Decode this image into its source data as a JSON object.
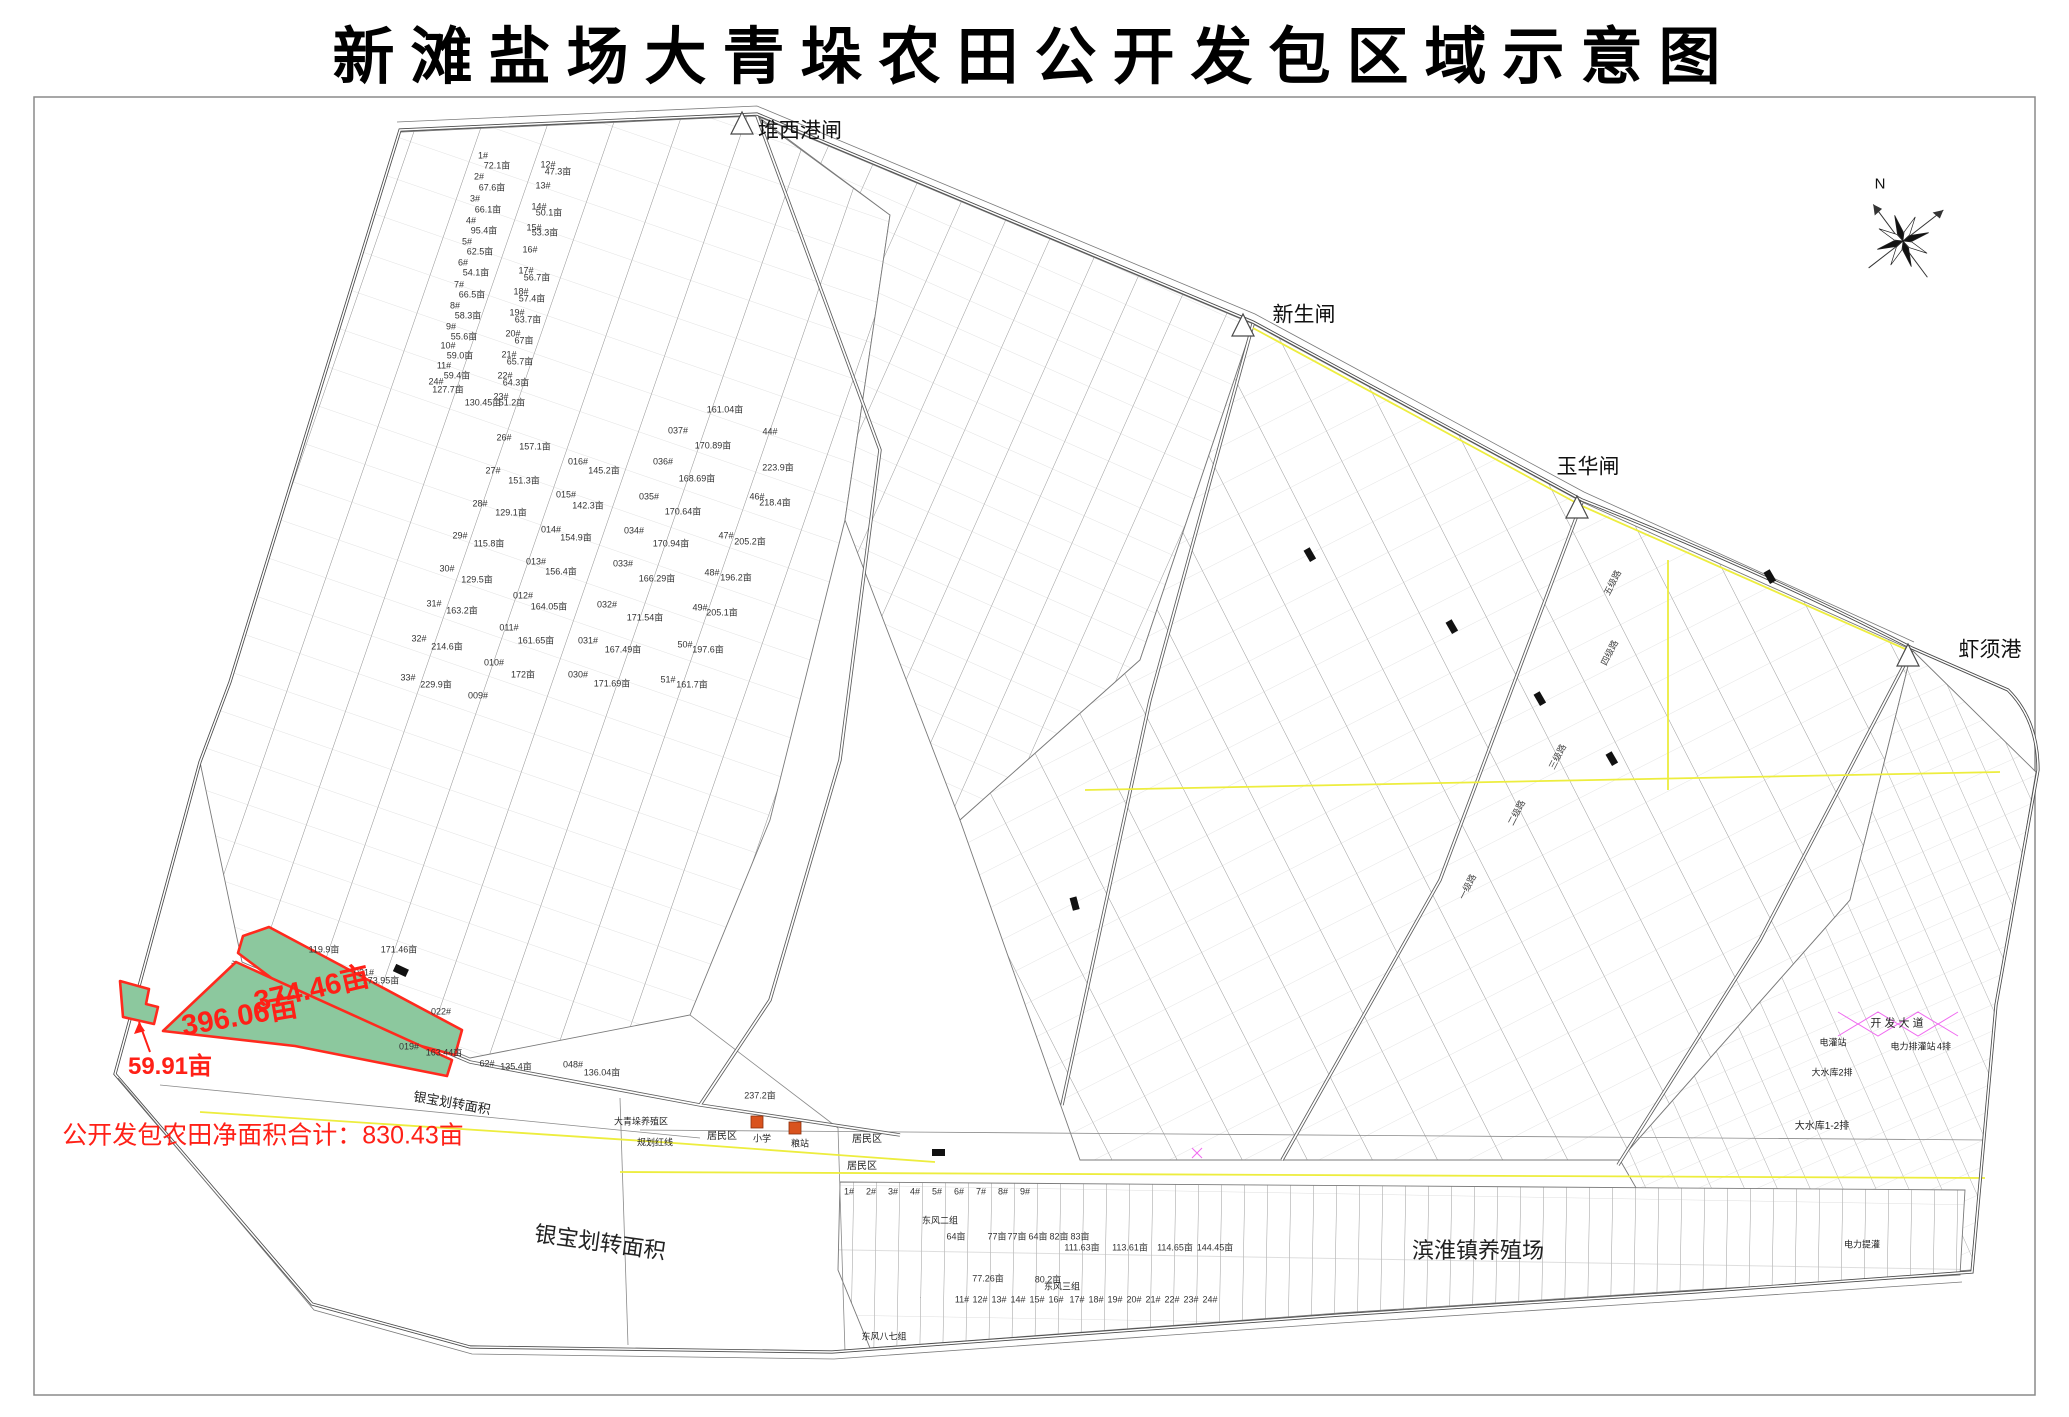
{
  "title": "新滩盐场大青垛农田公开发包区域示意图",
  "map": {
    "colors": {
      "highlight_fill": "#8CC89E",
      "highlight_stroke": "#FF2A1E",
      "highlight_text": "#FF2017",
      "road_yellow": "#EDED3E",
      "accent_magenta": "#F06AF0",
      "school_orange": "#D9531E",
      "line_gray": "#555555"
    },
    "gates": [
      {
        "t": "堆西港闸",
        "x": 800,
        "y": 131
      },
      {
        "t": "新生闸",
        "x": 1304,
        "y": 315
      },
      {
        "t": "玉华闸",
        "x": 1588,
        "y": 467
      },
      {
        "t": "虾须港",
        "x": 1990,
        "y": 650
      }
    ],
    "compass": [
      {
        "t": "N",
        "x": 1880,
        "y": 184
      }
    ],
    "highlights": [
      {
        "t": "374.46亩",
        "x": 312,
        "y": 990,
        "r": -13
      },
      {
        "t": "396.06亩",
        "x": 240,
        "y": 1017,
        "r": -10
      },
      {
        "t": "59.91亩",
        "x": 170,
        "y": 1067,
        "s": 24
      }
    ],
    "notes": [
      {
        "t": "公开发包农田净面积合计：830.43亩",
        "x": 263,
        "y": 1136
      }
    ],
    "zones": [
      {
        "t": "银宝划转面积",
        "x": 600,
        "y": 1243,
        "r": 8
      },
      {
        "t": "银宝划转面积",
        "x": 452,
        "y": 1103,
        "s": 13,
        "r": 10
      },
      {
        "t": "滨淮镇养殖场",
        "x": 1478,
        "y": 1251
      },
      {
        "t": "居民区",
        "x": 722,
        "y": 1137,
        "s": 10
      },
      {
        "t": "居民区",
        "x": 867,
        "y": 1140,
        "s": 10
      },
      {
        "t": "居民区",
        "x": 862,
        "y": 1167,
        "s": 10
      },
      {
        "t": "大青垛养殖区",
        "x": 641,
        "y": 1122,
        "s": 9
      },
      {
        "t": "规划红线",
        "x": 655,
        "y": 1143,
        "s": 9
      },
      {
        "t": "东风二组",
        "x": 940,
        "y": 1221,
        "s": 9
      },
      {
        "t": "东风三组",
        "x": 1062,
        "y": 1287,
        "s": 9
      },
      {
        "t": "东风八七组",
        "x": 884,
        "y": 1337,
        "s": 9
      },
      {
        "t": "大水库1-2排",
        "x": 1822,
        "y": 1127,
        "s": 10
      },
      {
        "t": "大水库2排",
        "x": 1832,
        "y": 1073,
        "s": 9
      },
      {
        "t": "电力排灌站",
        "x": 1913,
        "y": 1047,
        "s": 9
      },
      {
        "t": "电灌站",
        "x": 1833,
        "y": 1043,
        "s": 9
      },
      {
        "t": "电力提灌",
        "x": 1862,
        "y": 1245,
        "s": 9
      },
      {
        "t": "4排",
        "x": 1944,
        "y": 1047,
        "s": 9
      },
      {
        "t": "开 发 大 道",
        "x": 1897,
        "y": 1024,
        "s": 11
      },
      {
        "t": "小学",
        "x": 762,
        "y": 1139,
        "s": 9
      },
      {
        "t": "粮站",
        "x": 800,
        "y": 1144,
        "s": 9
      }
    ],
    "roads": [
      {
        "t": "五级路",
        "x": 1613,
        "y": 583
      },
      {
        "t": "四级路",
        "x": 1610,
        "y": 653
      },
      {
        "t": "三级路",
        "x": 1558,
        "y": 757
      },
      {
        "t": "二级路",
        "x": 1517,
        "y": 813
      },
      {
        "t": "一级路",
        "x": 1468,
        "y": 887
      }
    ],
    "parcels": [
      {
        "t": "1#",
        "x": 483,
        "y": 156
      },
      {
        "t": "72.1亩",
        "x": 497,
        "y": 166
      },
      {
        "t": "2#",
        "x": 479,
        "y": 177
      },
      {
        "t": "67.6亩",
        "x": 492,
        "y": 188
      },
      {
        "t": "3#",
        "x": 475,
        "y": 199
      },
      {
        "t": "66.1亩",
        "x": 488,
        "y": 210
      },
      {
        "t": "4#",
        "x": 471,
        "y": 221
      },
      {
        "t": "95.4亩",
        "x": 484,
        "y": 231
      },
      {
        "t": "5#",
        "x": 467,
        "y": 242
      },
      {
        "t": "62.5亩",
        "x": 480,
        "y": 252
      },
      {
        "t": "6#",
        "x": 463,
        "y": 263
      },
      {
        "t": "54.1亩",
        "x": 476,
        "y": 273
      },
      {
        "t": "7#",
        "x": 459,
        "y": 285
      },
      {
        "t": "66.5亩",
        "x": 472,
        "y": 295
      },
      {
        "t": "8#",
        "x": 455,
        "y": 306
      },
      {
        "t": "58.3亩",
        "x": 468,
        "y": 316
      },
      {
        "t": "9#",
        "x": 451,
        "y": 327
      },
      {
        "t": "55.6亩",
        "x": 464,
        "y": 337
      },
      {
        "t": "10#",
        "x": 448,
        "y": 346
      },
      {
        "t": "59.0亩",
        "x": 460,
        "y": 356
      },
      {
        "t": "11#",
        "x": 444,
        "y": 366
      },
      {
        "t": "59.4亩",
        "x": 457,
        "y": 376
      },
      {
        "t": "24#",
        "x": 436,
        "y": 382
      },
      {
        "t": "127.7亩",
        "x": 448,
        "y": 390
      },
      {
        "t": "12#",
        "x": 548,
        "y": 165
      },
      {
        "t": "47.3亩",
        "x": 558,
        "y": 172
      },
      {
        "t": "13#",
        "x": 543,
        "y": 186
      },
      {
        "t": "14#",
        "x": 539,
        "y": 207
      },
      {
        "t": "50.1亩",
        "x": 549,
        "y": 213
      },
      {
        "t": "15#",
        "x": 534,
        "y": 228
      },
      {
        "t": "53.3亩",
        "x": 545,
        "y": 233
      },
      {
        "t": "16#",
        "x": 530,
        "y": 250
      },
      {
        "t": "17#",
        "x": 526,
        "y": 271
      },
      {
        "t": "56.7亩",
        "x": 537,
        "y": 278
      },
      {
        "t": "18#",
        "x": 521,
        "y": 292
      },
      {
        "t": "57.4亩",
        "x": 532,
        "y": 299
      },
      {
        "t": "19#",
        "x": 517,
        "y": 313
      },
      {
        "t": "63.7亩",
        "x": 528,
        "y": 320
      },
      {
        "t": "20#",
        "x": 513,
        "y": 334
      },
      {
        "t": "67亩",
        "x": 524,
        "y": 341
      },
      {
        "t": "21#",
        "x": 509,
        "y": 355
      },
      {
        "t": "65.7亩",
        "x": 520,
        "y": 362
      },
      {
        "t": "22#",
        "x": 505,
        "y": 376
      },
      {
        "t": "64.3亩",
        "x": 516,
        "y": 383
      },
      {
        "t": "23#",
        "x": 501,
        "y": 397
      },
      {
        "t": "51.2亩",
        "x": 512,
        "y": 403
      },
      {
        "t": "130.45亩",
        "x": 483,
        "y": 403
      },
      {
        "t": "26#",
        "x": 504,
        "y": 438
      },
      {
        "t": "157.1亩",
        "x": 535,
        "y": 447
      },
      {
        "t": "27#",
        "x": 493,
        "y": 471
      },
      {
        "t": "151.3亩",
        "x": 524,
        "y": 481
      },
      {
        "t": "28#",
        "x": 480,
        "y": 504
      },
      {
        "t": "129.1亩",
        "x": 511,
        "y": 513
      },
      {
        "t": "29#",
        "x": 460,
        "y": 536
      },
      {
        "t": "115.8亩",
        "x": 489,
        "y": 544
      },
      {
        "t": "30#",
        "x": 447,
        "y": 569
      },
      {
        "t": "129.5亩",
        "x": 477,
        "y": 580
      },
      {
        "t": "31#",
        "x": 434,
        "y": 604
      },
      {
        "t": "163.2亩",
        "x": 462,
        "y": 611
      },
      {
        "t": "32#",
        "x": 419,
        "y": 639
      },
      {
        "t": "214.6亩",
        "x": 447,
        "y": 647
      },
      {
        "t": "33#",
        "x": 408,
        "y": 678
      },
      {
        "t": "229.9亩",
        "x": 436,
        "y": 685
      },
      {
        "t": "016#",
        "x": 578,
        "y": 462
      },
      {
        "t": "145.2亩",
        "x": 604,
        "y": 471
      },
      {
        "t": "015#",
        "x": 566,
        "y": 495
      },
      {
        "t": "142.3亩",
        "x": 588,
        "y": 506
      },
      {
        "t": "014#",
        "x": 551,
        "y": 530
      },
      {
        "t": "154.9亩",
        "x": 576,
        "y": 538
      },
      {
        "t": "013#",
        "x": 536,
        "y": 562
      },
      {
        "t": "156.4亩",
        "x": 561,
        "y": 572
      },
      {
        "t": "012#",
        "x": 523,
        "y": 596
      },
      {
        "t": "164.05亩",
        "x": 549,
        "y": 607
      },
      {
        "t": "011#",
        "x": 509,
        "y": 628
      },
      {
        "t": "161.65亩",
        "x": 536,
        "y": 641
      },
      {
        "t": "010#",
        "x": 494,
        "y": 663
      },
      {
        "t": "172亩",
        "x": 523,
        "y": 675
      },
      {
        "t": "009#",
        "x": 478,
        "y": 696
      },
      {
        "t": "161.04亩",
        "x": 725,
        "y": 410
      },
      {
        "t": "037#",
        "x": 678,
        "y": 431
      },
      {
        "t": "170.89亩",
        "x": 713,
        "y": 446
      },
      {
        "t": "036#",
        "x": 663,
        "y": 462
      },
      {
        "t": "168.69亩",
        "x": 697,
        "y": 479
      },
      {
        "t": "035#",
        "x": 649,
        "y": 497
      },
      {
        "t": "170.64亩",
        "x": 683,
        "y": 512
      },
      {
        "t": "034#",
        "x": 634,
        "y": 531
      },
      {
        "t": "170.94亩",
        "x": 671,
        "y": 544
      },
      {
        "t": "033#",
        "x": 623,
        "y": 564
      },
      {
        "t": "166.29亩",
        "x": 657,
        "y": 579
      },
      {
        "t": "032#",
        "x": 607,
        "y": 605
      },
      {
        "t": "171.54亩",
        "x": 645,
        "y": 618
      },
      {
        "t": "031#",
        "x": 588,
        "y": 641
      },
      {
        "t": "167.49亩",
        "x": 623,
        "y": 650
      },
      {
        "t": "030#",
        "x": 578,
        "y": 675
      },
      {
        "t": "171.69亩",
        "x": 612,
        "y": 684
      },
      {
        "t": "44#",
        "x": 770,
        "y": 432
      },
      {
        "t": "223.9亩",
        "x": 778,
        "y": 468
      },
      {
        "t": "46#",
        "x": 757,
        "y": 497
      },
      {
        "t": "218.4亩",
        "x": 775,
        "y": 503
      },
      {
        "t": "47#",
        "x": 726,
        "y": 536
      },
      {
        "t": "205.2亩",
        "x": 750,
        "y": 542
      },
      {
        "t": "48#",
        "x": 712,
        "y": 573
      },
      {
        "t": "196.2亩",
        "x": 736,
        "y": 578
      },
      {
        "t": "49#",
        "x": 700,
        "y": 608
      },
      {
        "t": "205.1亩",
        "x": 722,
        "y": 613
      },
      {
        "t": "50#",
        "x": 685,
        "y": 645
      },
      {
        "t": "197.6亩",
        "x": 708,
        "y": 650
      },
      {
        "t": "51#",
        "x": 668,
        "y": 680
      },
      {
        "t": "161.7亩",
        "x": 692,
        "y": 685
      },
      {
        "t": "119.9亩",
        "x": 324,
        "y": 950
      },
      {
        "t": "171.46亩",
        "x": 399,
        "y": 950
      },
      {
        "t": "021#",
        "x": 364,
        "y": 973
      },
      {
        "t": "173.95亩",
        "x": 381,
        "y": 981
      },
      {
        "t": "022#",
        "x": 441,
        "y": 1012
      },
      {
        "t": "019#",
        "x": 409,
        "y": 1047
      },
      {
        "t": "163.44亩",
        "x": 444,
        "y": 1053
      },
      {
        "t": "62#",
        "x": 487,
        "y": 1064
      },
      {
        "t": "135.4亩",
        "x": 516,
        "y": 1067
      },
      {
        "t": "048#",
        "x": 573,
        "y": 1065
      },
      {
        "t": "136.04亩",
        "x": 602,
        "y": 1073
      },
      {
        "t": "237.2亩",
        "x": 760,
        "y": 1096
      },
      {
        "t": "1#",
        "x": 849,
        "y": 1192
      },
      {
        "t": "2#",
        "x": 871,
        "y": 1192
      },
      {
        "t": "3#",
        "x": 893,
        "y": 1192
      },
      {
        "t": "4#",
        "x": 915,
        "y": 1192
      },
      {
        "t": "5#",
        "x": 937,
        "y": 1192
      },
      {
        "t": "6#",
        "x": 959,
        "y": 1192
      },
      {
        "t": "7#",
        "x": 981,
        "y": 1192
      },
      {
        "t": "8#",
        "x": 1003,
        "y": 1192
      },
      {
        "t": "9#",
        "x": 1025,
        "y": 1192
      },
      {
        "t": "64亩",
        "x": 956,
        "y": 1237
      },
      {
        "t": "77亩",
        "x": 997,
        "y": 1237
      },
      {
        "t": "77亩",
        "x": 1017,
        "y": 1237
      },
      {
        "t": "64亩",
        "x": 1038,
        "y": 1237
      },
      {
        "t": "82亩",
        "x": 1059,
        "y": 1237
      },
      {
        "t": "83亩",
        "x": 1080,
        "y": 1237
      },
      {
        "t": "77.26亩",
        "x": 988,
        "y": 1279
      },
      {
        "t": "80.2亩",
        "x": 1048,
        "y": 1280
      },
      {
        "t": "11#",
        "x": 962,
        "y": 1300
      },
      {
        "t": "12#",
        "x": 980,
        "y": 1300
      },
      {
        "t": "13#",
        "x": 999,
        "y": 1300
      },
      {
        "t": "14#",
        "x": 1018,
        "y": 1300
      },
      {
        "t": "15#",
        "x": 1037,
        "y": 1300
      },
      {
        "t": "16#",
        "x": 1056,
        "y": 1300
      },
      {
        "t": "17#",
        "x": 1077,
        "y": 1300
      },
      {
        "t": "18#",
        "x": 1096,
        "y": 1300
      },
      {
        "t": "19#",
        "x": 1115,
        "y": 1300
      },
      {
        "t": "20#",
        "x": 1134,
        "y": 1300
      },
      {
        "t": "21#",
        "x": 1153,
        "y": 1300
      },
      {
        "t": "22#",
        "x": 1172,
        "y": 1300
      },
      {
        "t": "23#",
        "x": 1191,
        "y": 1300
      },
      {
        "t": "24#",
        "x": 1210,
        "y": 1300
      },
      {
        "t": "111.63亩",
        "x": 1082,
        "y": 1248
      },
      {
        "t": "113.61亩",
        "x": 1130,
        "y": 1248
      },
      {
        "t": "114.65亩",
        "x": 1175,
        "y": 1248
      },
      {
        "t": "144.45亩",
        "x": 1215,
        "y": 1248
      }
    ]
  }
}
